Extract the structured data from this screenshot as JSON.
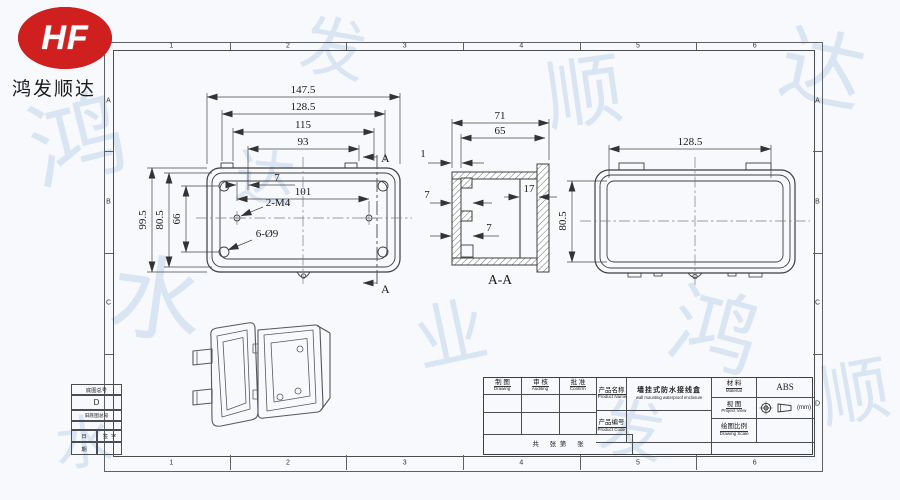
{
  "company": {
    "logo_text": "HF",
    "name": "鸿发顺达"
  },
  "frame": {
    "cols": [
      "1",
      "2",
      "3",
      "4",
      "5",
      "6"
    ],
    "rows": [
      "A",
      "B",
      "C",
      "D"
    ]
  },
  "views": {
    "front": {
      "dim_147_5": "147.5",
      "dim_128_5": "128.5",
      "dim_115": "115",
      "dim_93": "93",
      "dim_7": "7",
      "dim_101": "101",
      "label_2_m4": "2-M4",
      "label_6_o9": "6-Ø9",
      "dim_99_5": "99.5",
      "dim_80_5": "80.5",
      "dim_66": "66",
      "section_a_top": "A",
      "section_a_bottom": "A"
    },
    "section": {
      "dim_71": "71",
      "dim_65": "65",
      "dim_1": "1",
      "dim_7_upper": "7",
      "dim_7_lower": "7",
      "dim_17": "17",
      "label": "A-A"
    },
    "back": {
      "dim_128_5": "128.5",
      "dim_80_5": "80.5"
    }
  },
  "title_block": {
    "drawing_cn": "制 图",
    "drawing_en": "Drawing",
    "auditing_cn": "审 核",
    "auditing_en": "Auditing",
    "confirm_cn": "批 准",
    "confirm_en": "Confirm",
    "product_name_cn": "产品名称",
    "product_name_en": "Product Name",
    "product_name_value_cn": "墙挂式防水接线盒",
    "product_name_value_en": "wall mounting waterproof enclosure",
    "product_code_cn": "产品编号",
    "product_code_en": "Product Code",
    "material_cn": "材 料",
    "material_en": "Material",
    "material_value": "ABS",
    "view_cn": "视 图",
    "view_en": "Project View",
    "scale_cn": "绘图比例",
    "scale_en": "Drawing Scale",
    "unit": "(mm)",
    "sheet_info": "共      张  第      张"
  },
  "corner_block": {
    "base_drawing_no": "底图总号",
    "old_base_drawing_no": "旧底图总号",
    "date_1": "日",
    "date_2": "期",
    "sign": "签  字",
    "zone_d": "D"
  },
  "watermark": {
    "chars": [
      "鸿",
      "发",
      "顺",
      "达",
      "水",
      "业"
    ]
  },
  "colors": {
    "logo_red": "#cf1f1f",
    "line": "#3e3e3e",
    "watermark_blue": "#96b6dc"
  }
}
